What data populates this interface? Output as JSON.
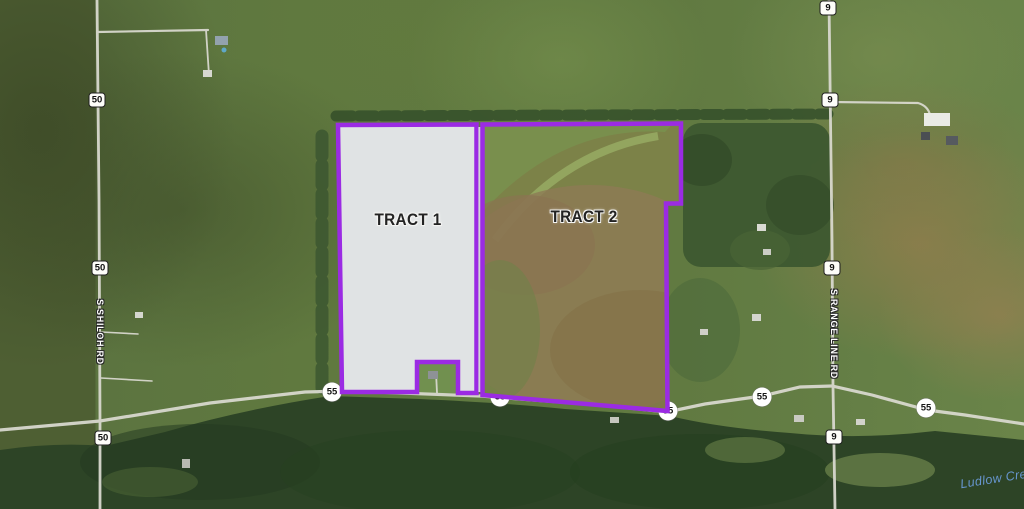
{
  "map": {
    "tracts": [
      {
        "label": "TRACT 1"
      },
      {
        "label": "TRACT 2"
      }
    ],
    "roads": {
      "shiloh": "S SHILOH RD",
      "range_line": "S RANGE LINE RD"
    },
    "water": {
      "label": "Ludlow Cre"
    },
    "shields": [
      {
        "shape": "rect",
        "label": "50",
        "x": 97,
        "y": 100
      },
      {
        "shape": "rect",
        "label": "50",
        "x": 100,
        "y": 268
      },
      {
        "shape": "rect",
        "label": "50",
        "x": 103,
        "y": 438
      },
      {
        "shape": "rect",
        "label": "9",
        "x": 828,
        "y": 8
      },
      {
        "shape": "rect",
        "label": "9",
        "x": 830,
        "y": 100
      },
      {
        "shape": "rect",
        "label": "9",
        "x": 832,
        "y": 268
      },
      {
        "shape": "rect",
        "label": "9",
        "x": 834,
        "y": 437
      },
      {
        "shape": "circle",
        "label": "55",
        "x": 332,
        "y": 392
      },
      {
        "shape": "circle",
        "label": "55",
        "x": 500,
        "y": 397
      },
      {
        "shape": "circle",
        "label": "55",
        "x": 668,
        "y": 411
      },
      {
        "shape": "circle",
        "label": "55",
        "x": 762,
        "y": 397
      },
      {
        "shape": "circle",
        "label": "55",
        "x": 926,
        "y": 408
      }
    ],
    "colors": {
      "boundary": "#9B2BE3",
      "tract1_fill": "#E0E3E4",
      "water_text": "#6796CF"
    }
  }
}
